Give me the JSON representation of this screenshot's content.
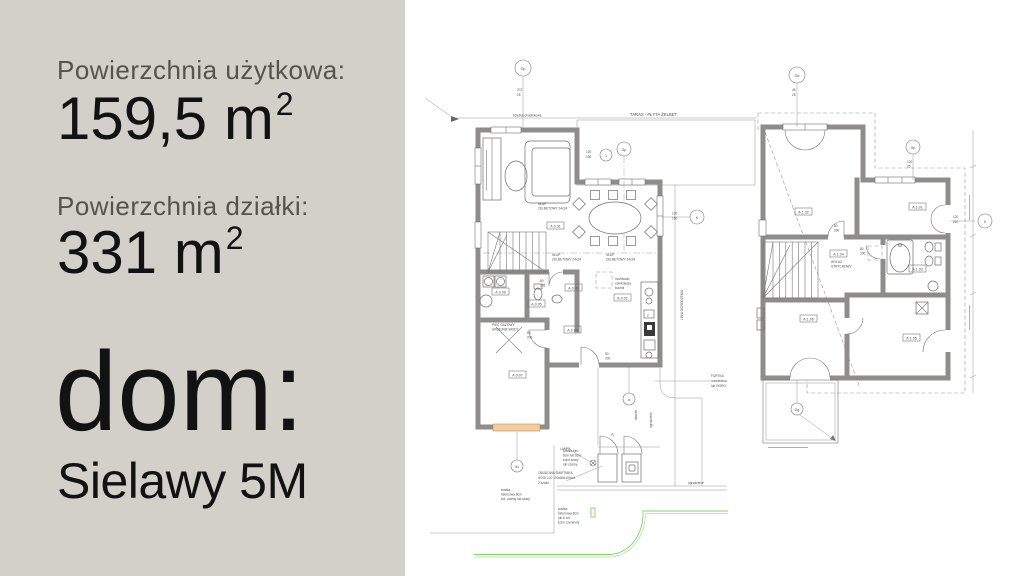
{
  "panel": {
    "bg_color": "#d3cfc9",
    "label_color": "#56524d",
    "value_color": "#121212",
    "usable_area_label": "Powierzchnia użytkowa:",
    "usable_area_value": "159,5 m",
    "usable_area_exponent": "2",
    "plot_area_label": "Powierzchnia działki:",
    "plot_area_value": "331 m",
    "plot_area_exponent": "2",
    "house_prefix": "dom:",
    "house_name": "Sielawy 5M"
  },
  "ground_floor": {
    "grid_bubbles": {
      "top": "Gp",
      "mid": "Gp",
      "mid2": "1",
      "right": "6",
      "gate": "d1",
      "walk": "d"
    },
    "dim_top": [
      "272",
      "25"
    ],
    "dim_mid": [
      "120",
      "150"
    ],
    "dim_right": [
      "120",
      "150"
    ],
    "rooms": [
      "A.0.01",
      "A.0.02",
      "A.0.03",
      "A.0.04",
      "A.0.05",
      "A.0.06",
      "A.0.07"
    ],
    "terrace_label": "TARAS - PŁYTA ŻELBET.",
    "walkway_label": "ścieżka chodnikowa",
    "column_note": [
      "SŁUP",
      "ŻELBETOWY 24x24"
    ],
    "kitchen_note": [
      "możliwość",
      "zamknięcia",
      "kuchni"
    ],
    "garage_note": [
      "PIEC GAZOWY",
      "GRZEJNIK WODY"
    ],
    "gate_note": [
      "FURTKA",
      "rozwierana",
      "lub OGRO"
    ],
    "bin_note": [
      "OBUDOWA ŚMIETNIKA",
      "HOGI 120 100x85x100cm",
      "2 sztuki"
    ],
    "paving_note_1": [
      "kostka bet.",
      "8cm lub 6cm",
      "kolor szary",
      "lub czarny"
    ],
    "paving_note_2": [
      "kostka",
      "betonowa 8cm",
      "kol. czarny lub szary"
    ],
    "paving_note_3": [
      "kostka",
      "betonowa 8cm",
      "lub 6 cm",
      "kolor czerwony"
    ],
    "lamp_label": "LAMPA",
    "entry_marker": "A",
    "canopy_label": "daszek",
    "fence_label": "ogrodzenie",
    "fence_line_label": "LINIA OGRODZENIA",
    "door_dims": [
      [
        "80",
        "205"
      ],
      [
        "90",
        "200"
      ],
      [
        "80",
        "200"
      ]
    ]
  },
  "upper_floor": {
    "grid_bubbles": {
      "top": "Gd",
      "mid": "Gp",
      "right": "6",
      "balcony": "Gg"
    },
    "dim_top": [
      "46",
      "25"
    ],
    "dim_mid": [
      "120",
      "25"
    ],
    "dim_right": [
      "120",
      "210"
    ],
    "rooms": [
      "A.1.01",
      "A.1.02",
      "A.1.03",
      "A.1.04",
      "A.1.05",
      "A.1.06"
    ],
    "attic_note": [
      "WYŁAZ",
      "STRYCHOWY"
    ],
    "door_dims": [
      [
        "80",
        "200"
      ],
      [
        "80",
        "200"
      ]
    ]
  }
}
